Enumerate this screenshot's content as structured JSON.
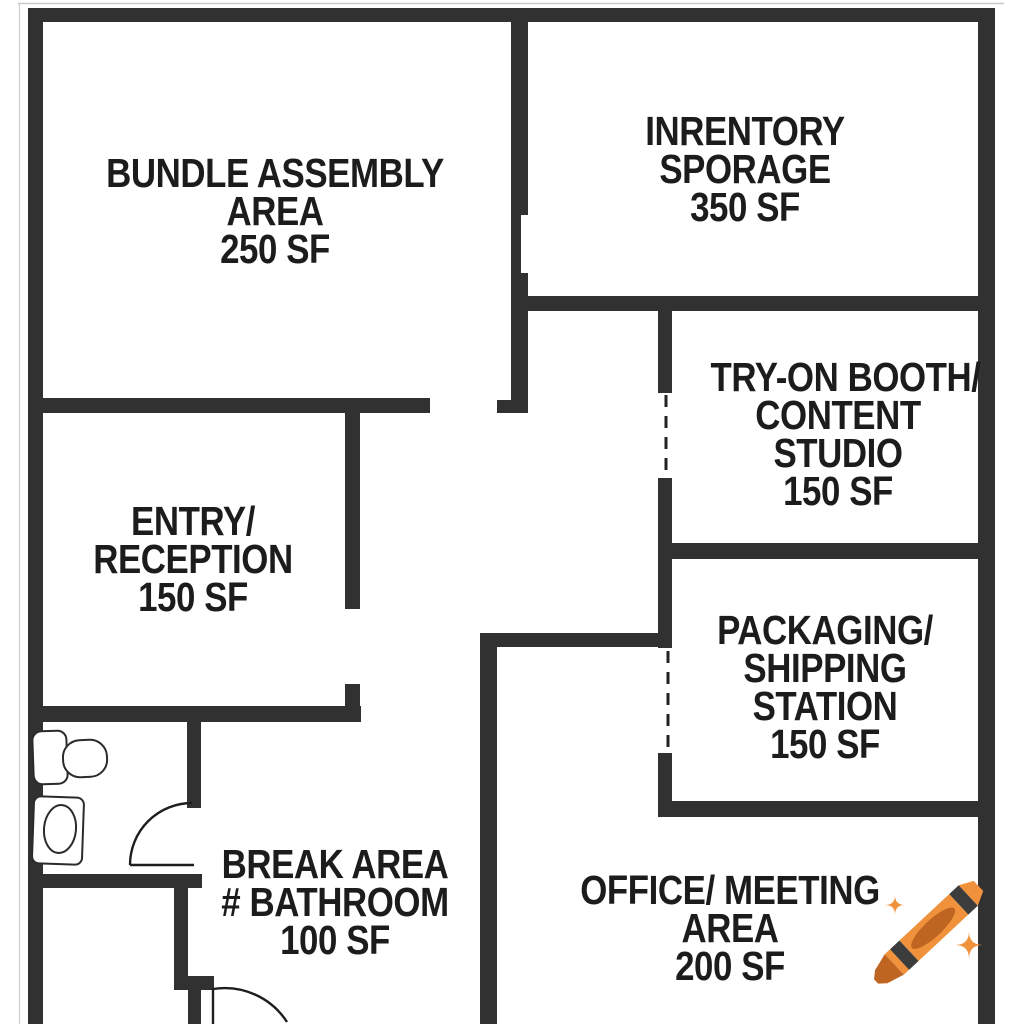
{
  "title": "Studio floor plan",
  "colors": {
    "wall": "#313131",
    "background": "#ffffff",
    "text": "#1c1c1c",
    "crayon_body": "#F0923C",
    "crayon_dark": "#BF6522",
    "crayon_band": "#3C3C3C",
    "sparkle": "#F0923C"
  },
  "rooms": [
    {
      "id": "bundle-assembly",
      "area": "250 SF",
      "lines": [
        "BUNDLE ASSEMBLY",
        "AREA",
        "250 SF"
      ]
    },
    {
      "id": "inventory-storage",
      "area": "350 SF",
      "lines": [
        "INRENTORY",
        "SPORAGE",
        "350 SF"
      ]
    },
    {
      "id": "try-on-booth",
      "area": "150 SF",
      "lines": [
        "TRY-ON BOOTH/",
        "CONTENT",
        "STUDIO",
        "150 SF"
      ]
    },
    {
      "id": "entry-reception",
      "area": "150 SF",
      "lines": [
        "ENTRY/",
        "RECEPTION",
        "150 SF"
      ]
    },
    {
      "id": "packaging-shipping",
      "area": "150 SF",
      "lines": [
        "PACKAGING/",
        "SHIPPING",
        "STATION",
        "150 SF"
      ]
    },
    {
      "id": "break-area",
      "area": "100 SF",
      "lines": [
        "BREAK AREA",
        "# BATHROOM",
        "100 SF"
      ]
    },
    {
      "id": "office-meeting",
      "area": "200 SF",
      "lines": [
        "OFFICE/ MEETING",
        "AREA",
        "200 SF"
      ]
    }
  ],
  "symbols": {
    "toilet": "toilet-plan-symbol",
    "sink": "sink-plan-symbol",
    "door_swings": 2,
    "dashed_openings": 2
  },
  "decor": {
    "crayon": "orange-crayon-emoji",
    "sparkles": 2
  }
}
